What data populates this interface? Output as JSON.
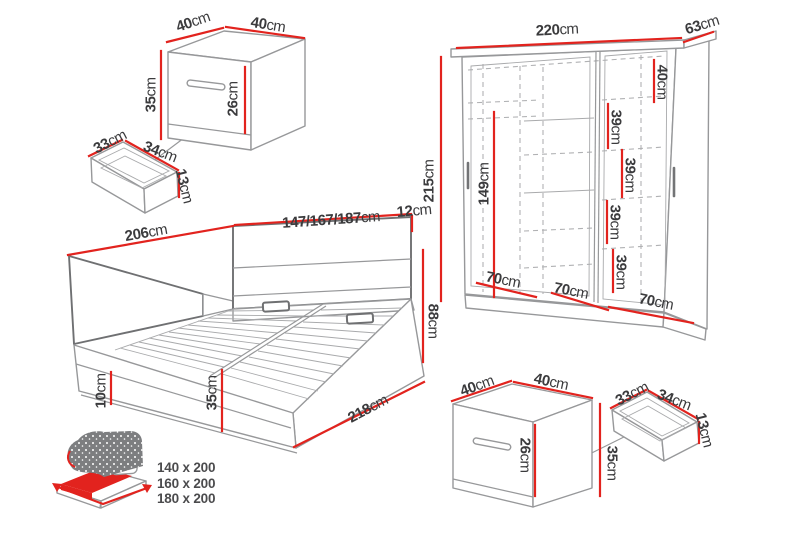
{
  "palette": {
    "red": "#e2231e",
    "line": "#97989a",
    "line_dark": "#6f7072",
    "text": "#3b3b3d"
  },
  "dimensions": {
    "nightstand_top": {
      "width_left": {
        "v": "40",
        "u": "cm"
      },
      "width_right": {
        "v": "40",
        "u": "cm"
      },
      "height": {
        "v": "35",
        "u": "cm"
      },
      "drawer_front_height": {
        "v": "26",
        "u": "cm"
      }
    },
    "drawer_top": {
      "depth": {
        "v": "33",
        "u": "cm"
      },
      "width": {
        "v": "34",
        "u": "cm"
      },
      "height": {
        "v": "13",
        "u": "cm"
      }
    },
    "wardrobe": {
      "width": {
        "v": "220",
        "u": "cm"
      },
      "depth": {
        "v": "63",
        "u": "cm"
      },
      "height": {
        "v": "215",
        "u": "cm"
      },
      "inner_height": {
        "v": "149",
        "u": "cm"
      },
      "top_section": {
        "v": "40",
        "u": "cm"
      },
      "shelf_1": {
        "v": "39",
        "u": "cm"
      },
      "shelf_2": {
        "v": "39",
        "u": "cm"
      },
      "shelf_3": {
        "v": "39",
        "u": "cm"
      },
      "shelf_4": {
        "v": "39",
        "u": "cm"
      },
      "section_1": {
        "v": "70",
        "u": "cm"
      },
      "section_2": {
        "v": "70",
        "u": "cm"
      },
      "section_3": {
        "v": "70",
        "u": "cm"
      }
    },
    "bed": {
      "length_side": {
        "v": "206",
        "u": "cm"
      },
      "width_options": {
        "v": "147/167/187",
        "u": "cm"
      },
      "headboard_depth": {
        "v": "12",
        "u": "cm"
      },
      "total_height": {
        "v": "88",
        "u": "cm"
      },
      "plinth_height": {
        "v": "10",
        "u": "cm"
      },
      "frame_height": {
        "v": "35",
        "u": "cm"
      },
      "length_total": {
        "v": "218",
        "u": "cm"
      }
    },
    "nightstand_bottom": {
      "width_left": {
        "v": "40",
        "u": "cm"
      },
      "width_right": {
        "v": "40",
        "u": "cm"
      },
      "drawer_front_height": {
        "v": "26",
        "u": "cm"
      },
      "height": {
        "v": "35",
        "u": "cm"
      }
    },
    "drawer_bottom": {
      "depth": {
        "v": "33",
        "u": "cm"
      },
      "width": {
        "v": "34",
        "u": "cm"
      },
      "height": {
        "v": "13",
        "u": "cm"
      }
    }
  },
  "legend": {
    "mattress_sizes": [
      "140 x 200",
      "160 x 200",
      "180 x 200"
    ]
  }
}
